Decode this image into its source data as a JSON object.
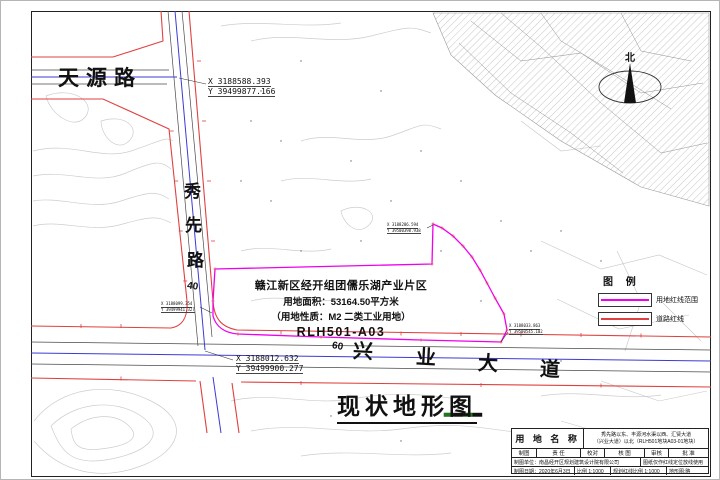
{
  "map": {
    "title": "现状地形图",
    "north_label": "北",
    "roads": {
      "tianyuan": "天源路",
      "xiuxian_chars": [
        "秀",
        "先",
        "路"
      ],
      "xiuxian_width": "40",
      "xingye_chars": [
        "兴",
        "业",
        "大",
        "道"
      ],
      "xingye_width": "60"
    },
    "parcel_block": {
      "line1": "赣江新区经开组团儒乐湖产业片区",
      "line2": "用地面积：53164.50平方米",
      "line3": "（用地性质：M2 二类工业用地）",
      "code": "RLH501-A03"
    },
    "coords": {
      "north_junction": {
        "x": "X 3188588.393",
        "y": "Y 39499877.166"
      },
      "south_junction": {
        "x": "X 3188012.632",
        "y": "Y 39499900.277"
      },
      "parcel_nw": {
        "x": "X 3188286.594",
        "y": "Y 39500398.938"
      },
      "parcel_se": {
        "x": "X 3188033.863",
        "y": "Y 39500545.102"
      },
      "parcel_sw": {
        "x": "X 3188099.354",
        "y": "Y 39499941.327"
      }
    }
  },
  "legend": {
    "title": "图 例",
    "items": [
      {
        "label": "用地红线范围",
        "color": "#ee00ee"
      },
      {
        "label": "道路红线",
        "color": "#e04040"
      }
    ]
  },
  "titleblock": {
    "name_label": "用 地 名 称",
    "name_value_line1": "秀先路以东、丰源河水渠以西、汇贤大道",
    "name_value_line2": "（兴业大道）以北（RLH501地块A03-01地块）",
    "fields": [
      "制图",
      "责 任",
      "校对",
      "核 图",
      "审核",
      "批 准"
    ],
    "maker_row": {
      "unit": "制图单位：南昌经开区规划建筑设计院有限公司",
      "note": "图纸仅作红线定位放线使用"
    },
    "date_row": {
      "date": "制图日期：2020年6月3日",
      "scale": "比例 1:1000",
      "redline": "规划红线比例 1:1000",
      "terrain": "地形图:略"
    }
  },
  "colors": {
    "parcel_redline": "#ee00ee",
    "road_redline": "#e04040",
    "centerline_blue": "#3b3bd6"
  }
}
